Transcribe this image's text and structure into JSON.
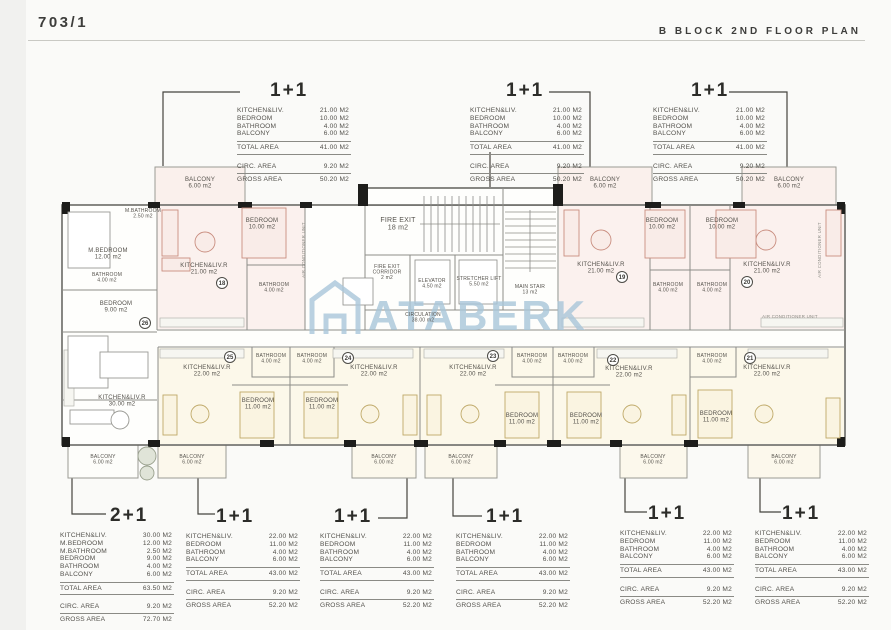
{
  "header": {
    "sheet_number": "703/1",
    "title": "B BLOCK 2ND FLOOR PLAN"
  },
  "colors": {
    "wall": "#6a6a66",
    "wall_dark": "#1d1d1b",
    "unit_pink": "#c98e80",
    "unit_pink_fill": "#f9ece8",
    "unit_tan": "#bfa968",
    "unit_tan_fill": "#faf4e1",
    "watermark_blue": "#a9c6da",
    "label_text": "#55524c"
  },
  "summaries": {
    "top": [
      {
        "type": "1+1",
        "items": [
          [
            "KITCHEN&LIV.",
            "21.00 M2"
          ],
          [
            "BEDROOM",
            "10.00 M2"
          ],
          [
            "BATHROOM",
            "4.00 M2"
          ],
          [
            "BALCONY",
            "6.00 M2"
          ]
        ],
        "total": [
          "TOTAL AREA",
          "41.00 M2"
        ],
        "circ": [
          "CIRC. AREA",
          "9.20 M2"
        ],
        "gross": [
          "GROSS AREA",
          "50.20 M2"
        ]
      },
      {
        "type": "1+1",
        "items": [
          [
            "KITCHEN&LIV.",
            "21.00 M2"
          ],
          [
            "BEDROOM",
            "10.00 M2"
          ],
          [
            "BATHROOM",
            "4.00 M2"
          ],
          [
            "BALCONY",
            "6.00 M2"
          ]
        ],
        "total": [
          "TOTAL AREA",
          "41.00 M2"
        ],
        "circ": [
          "CIRC. AREA",
          "9.20 M2"
        ],
        "gross": [
          "GROSS AREA",
          "50.20 M2"
        ]
      },
      {
        "type": "1+1",
        "items": [
          [
            "KITCHEN&LIV.",
            "21.00 M2"
          ],
          [
            "BEDROOM",
            "10.00 M2"
          ],
          [
            "BATHROOM",
            "4.00 M2"
          ],
          [
            "BALCONY",
            "6.00 M2"
          ]
        ],
        "total": [
          "TOTAL AREA",
          "41.00 M2"
        ],
        "circ": [
          "CIRC. AREA",
          "9.20 M2"
        ],
        "gross": [
          "GROSS AREA",
          "50.20 M2"
        ]
      }
    ],
    "bottom": [
      {
        "type": "2+1",
        "items": [
          [
            "KITCHEN&LIV.",
            "30.00 M2"
          ],
          [
            "M.BEDROOM",
            "12.00 M2"
          ],
          [
            "M.BATHROOM",
            "2.50 M2"
          ],
          [
            "BEDROOM",
            "9.00 M2"
          ],
          [
            "BATHROOM",
            "4.00 M2"
          ],
          [
            "BALCONY",
            "6.00 M2"
          ]
        ],
        "total": [
          "TOTAL AREA",
          "63.50 M2"
        ],
        "circ": [
          "CIRC. AREA",
          "9.20 M2"
        ],
        "gross": [
          "GROSS AREA",
          "72.70 M2"
        ]
      },
      {
        "type": "1+1",
        "items": [
          [
            "KITCHEN&LIV.",
            "22.00 M2"
          ],
          [
            "BEDROOM",
            "11.00 M2"
          ],
          [
            "BATHROOM",
            "4.00 M2"
          ],
          [
            "BALCONY",
            "6.00 M2"
          ]
        ],
        "total": [
          "TOTAL AREA",
          "43.00 M2"
        ],
        "circ": [
          "CIRC. AREA",
          "9.20 M2"
        ],
        "gross": [
          "GROSS AREA",
          "52.20 M2"
        ]
      },
      {
        "type": "1+1",
        "items": [
          [
            "KITCHEN&LIV.",
            "22.00 M2"
          ],
          [
            "BEDROOM",
            "11.00 M2"
          ],
          [
            "BATHROOM",
            "4.00 M2"
          ],
          [
            "BALCONY",
            "6.00 M2"
          ]
        ],
        "total": [
          "TOTAL AREA",
          "43.00 M2"
        ],
        "circ": [
          "CIRC. AREA",
          "9.20 M2"
        ],
        "gross": [
          "GROSS AREA",
          "52.20 M2"
        ]
      },
      {
        "type": "1+1",
        "items": [
          [
            "KITCHEN&LIV.",
            "22.00 M2"
          ],
          [
            "BEDROOM",
            "11.00 M2"
          ],
          [
            "BATHROOM",
            "4.00 M2"
          ],
          [
            "BALCONY",
            "6.00 M2"
          ]
        ],
        "total": [
          "TOTAL AREA",
          "43.00 M2"
        ],
        "circ": [
          "CIRC. AREA",
          "9.20 M2"
        ],
        "gross": [
          "GROSS AREA",
          "52.20 M2"
        ]
      },
      {
        "type": "1+1",
        "items": [
          [
            "KITCHEN&LIV.",
            "22.00 M2"
          ],
          [
            "BEDROOM",
            "11.00 M2"
          ],
          [
            "BATHROOM",
            "4.00 M2"
          ],
          [
            "BALCONY",
            "6.00 M2"
          ]
        ],
        "total": [
          "TOTAL AREA",
          "43.00 M2"
        ],
        "circ": [
          "CIRC. AREA",
          "9.20 M2"
        ],
        "gross": [
          "GROSS AREA",
          "52.20 M2"
        ]
      },
      {
        "type": "1+1",
        "items": [
          [
            "KITCHEN&LIV.",
            "22.00 M2"
          ],
          [
            "BEDROOM",
            "11.00 M2"
          ],
          [
            "BATHROOM",
            "4.00 M2"
          ],
          [
            "BALCONY",
            "6.00 M2"
          ]
        ],
        "total": [
          "TOTAL AREA",
          "43.00 M2"
        ],
        "circ": [
          "CIRC. AREA",
          "9.20 M2"
        ],
        "gross": [
          "GROSS AREA",
          "52.20 M2"
        ]
      }
    ]
  },
  "plan": {
    "watermark": "ATABERK",
    "rooms": [
      {
        "n": "BALCONY",
        "a": "6.00 m2",
        "x": 200,
        "y": 181,
        "s": "s"
      },
      {
        "n": "BALCONY",
        "a": "6.00 m2",
        "x": 605,
        "y": 181,
        "s": "s"
      },
      {
        "n": "BALCONY",
        "a": "6.00 m2",
        "x": 789,
        "y": 181,
        "s": "s"
      },
      {
        "n": "M.BEDROOM",
        "a": "12.00 m2",
        "x": 108,
        "y": 252,
        "s": "s"
      },
      {
        "n": "M.BATHROOM",
        "a": "2.50 m2",
        "x": 143,
        "y": 212,
        "s": "t"
      },
      {
        "n": "BATHROOM",
        "a": "4.00 m2",
        "x": 107,
        "y": 276,
        "s": "t"
      },
      {
        "n": "BEDROOM",
        "a": "9.00 m2",
        "x": 116,
        "y": 305,
        "s": "s"
      },
      {
        "n": "KITCHEN&LIV.R",
        "a": "30.00 m2",
        "x": 122,
        "y": 399,
        "s": "s"
      },
      {
        "n": "KITCHEN&LIV.R",
        "a": "21.00 m2",
        "x": 204,
        "y": 267,
        "s": "s"
      },
      {
        "n": "BEDROOM",
        "a": "10.00 m2",
        "x": 262,
        "y": 222,
        "s": "s"
      },
      {
        "n": "BATHROOM",
        "a": "4.00 m2",
        "x": 274,
        "y": 286,
        "s": "t"
      },
      {
        "n": "FIRE EXIT",
        "a": "18 m2",
        "x": 398,
        "y": 222,
        "s": "m"
      },
      {
        "n": "FIRE EXIT CORRIDOR",
        "a": "2 m2",
        "x": 387,
        "y": 268,
        "s": "t"
      },
      {
        "n": "ELEVATOR",
        "a": "4.50 m2",
        "x": 432,
        "y": 282,
        "s": "t"
      },
      {
        "n": "STRETCHER LIFT",
        "a": "5.50 m2",
        "x": 479,
        "y": 280,
        "s": "t"
      },
      {
        "n": "MAIN STAIR",
        "a": "13 m2",
        "x": 530,
        "y": 288,
        "s": "t"
      },
      {
        "n": "CIRCULATION",
        "a": "38.00 m2",
        "x": 423,
        "y": 316,
        "s": "t"
      },
      {
        "n": "KITCHEN&LIV.R",
        "a": "21.00 m2",
        "x": 601,
        "y": 266,
        "s": "s"
      },
      {
        "n": "BEDROOM",
        "a": "10.00 m2",
        "x": 662,
        "y": 222,
        "s": "s"
      },
      {
        "n": "BATHROOM",
        "a": "4.00 m2",
        "x": 668,
        "y": 286,
        "s": "t"
      },
      {
        "n": "BATHROOM",
        "a": "4.00 m2",
        "x": 712,
        "y": 286,
        "s": "t"
      },
      {
        "n": "BEDROOM",
        "a": "10.00 m2",
        "x": 722,
        "y": 222,
        "s": "s"
      },
      {
        "n": "KITCHEN&LIV.R",
        "a": "21.00 m2",
        "x": 767,
        "y": 266,
        "s": "s"
      },
      {
        "n": "KITCHEN&LIV.R",
        "a": "22.00 m2",
        "x": 207,
        "y": 369,
        "s": "s"
      },
      {
        "n": "BATHROOM",
        "a": "4.00 m2",
        "x": 271,
        "y": 357,
        "s": "t"
      },
      {
        "n": "BATHROOM",
        "a": "4.00 m2",
        "x": 312,
        "y": 357,
        "s": "t"
      },
      {
        "n": "BEDROOM",
        "a": "11.00 m2",
        "x": 258,
        "y": 402,
        "s": "s"
      },
      {
        "n": "BEDROOM",
        "a": "11.00 m2",
        "x": 322,
        "y": 402,
        "s": "s"
      },
      {
        "n": "KITCHEN&LIV.R",
        "a": "22.00 m2",
        "x": 374,
        "y": 369,
        "s": "s"
      },
      {
        "n": "KITCHEN&LIV.R",
        "a": "22.00 m2",
        "x": 473,
        "y": 369,
        "s": "s"
      },
      {
        "n": "BATHROOM",
        "a": "4.00 m2",
        "x": 532,
        "y": 357,
        "s": "t"
      },
      {
        "n": "BATHROOM",
        "a": "4.00 m2",
        "x": 573,
        "y": 357,
        "s": "t"
      },
      {
        "n": "BEDROOM",
        "a": "11.00 m2",
        "x": 522,
        "y": 417,
        "s": "s"
      },
      {
        "n": "BEDROOM",
        "a": "11.00 m2",
        "x": 586,
        "y": 417,
        "s": "s"
      },
      {
        "n": "KITCHEN&LIV.R",
        "a": "22.00 m2",
        "x": 629,
        "y": 370,
        "s": "s"
      },
      {
        "n": "BATHROOM",
        "a": "4.00 m2",
        "x": 712,
        "y": 357,
        "s": "t"
      },
      {
        "n": "BEDROOM",
        "a": "11.00 m2",
        "x": 716,
        "y": 415,
        "s": "s"
      },
      {
        "n": "KITCHEN&LIV.R",
        "a": "22.00 m2",
        "x": 767,
        "y": 369,
        "s": "s"
      },
      {
        "n": "BALCONY",
        "a": "6.00 m2",
        "x": 103,
        "y": 458,
        "s": "t"
      },
      {
        "n": "BALCONY",
        "a": "6.00 m2",
        "x": 192,
        "y": 458,
        "s": "t"
      },
      {
        "n": "BALCONY",
        "a": "6.00 m2",
        "x": 384,
        "y": 458,
        "s": "t"
      },
      {
        "n": "BALCONY",
        "a": "6.00 m2",
        "x": 461,
        "y": 458,
        "s": "t"
      },
      {
        "n": "BALCONY",
        "a": "6.00 m2",
        "x": 653,
        "y": 458,
        "s": "t"
      },
      {
        "n": "BALCONY",
        "a": "6.00 m2",
        "x": 784,
        "y": 458,
        "s": "t"
      }
    ],
    "unit_numbers": [
      {
        "n": "18",
        "x": 222,
        "y": 283
      },
      {
        "n": "19",
        "x": 622,
        "y": 277
      },
      {
        "n": "20",
        "x": 747,
        "y": 282
      },
      {
        "n": "21",
        "x": 750,
        "y": 358
      },
      {
        "n": "22",
        "x": 613,
        "y": 360
      },
      {
        "n": "23",
        "x": 493,
        "y": 356
      },
      {
        "n": "24",
        "x": 348,
        "y": 358
      },
      {
        "n": "25",
        "x": 230,
        "y": 357
      },
      {
        "n": "26",
        "x": 145,
        "y": 323
      }
    ],
    "notes": [
      {
        "t": "AIR CONDITIONER UNIT",
        "x": 305,
        "y": 250,
        "r": -90
      },
      {
        "t": "AIR CONDITIONER UNIT",
        "x": 790,
        "y": 318,
        "r": 0
      },
      {
        "t": "AIR CONDITIONER UNIT",
        "x": 821,
        "y": 250,
        "r": -90
      }
    ]
  }
}
